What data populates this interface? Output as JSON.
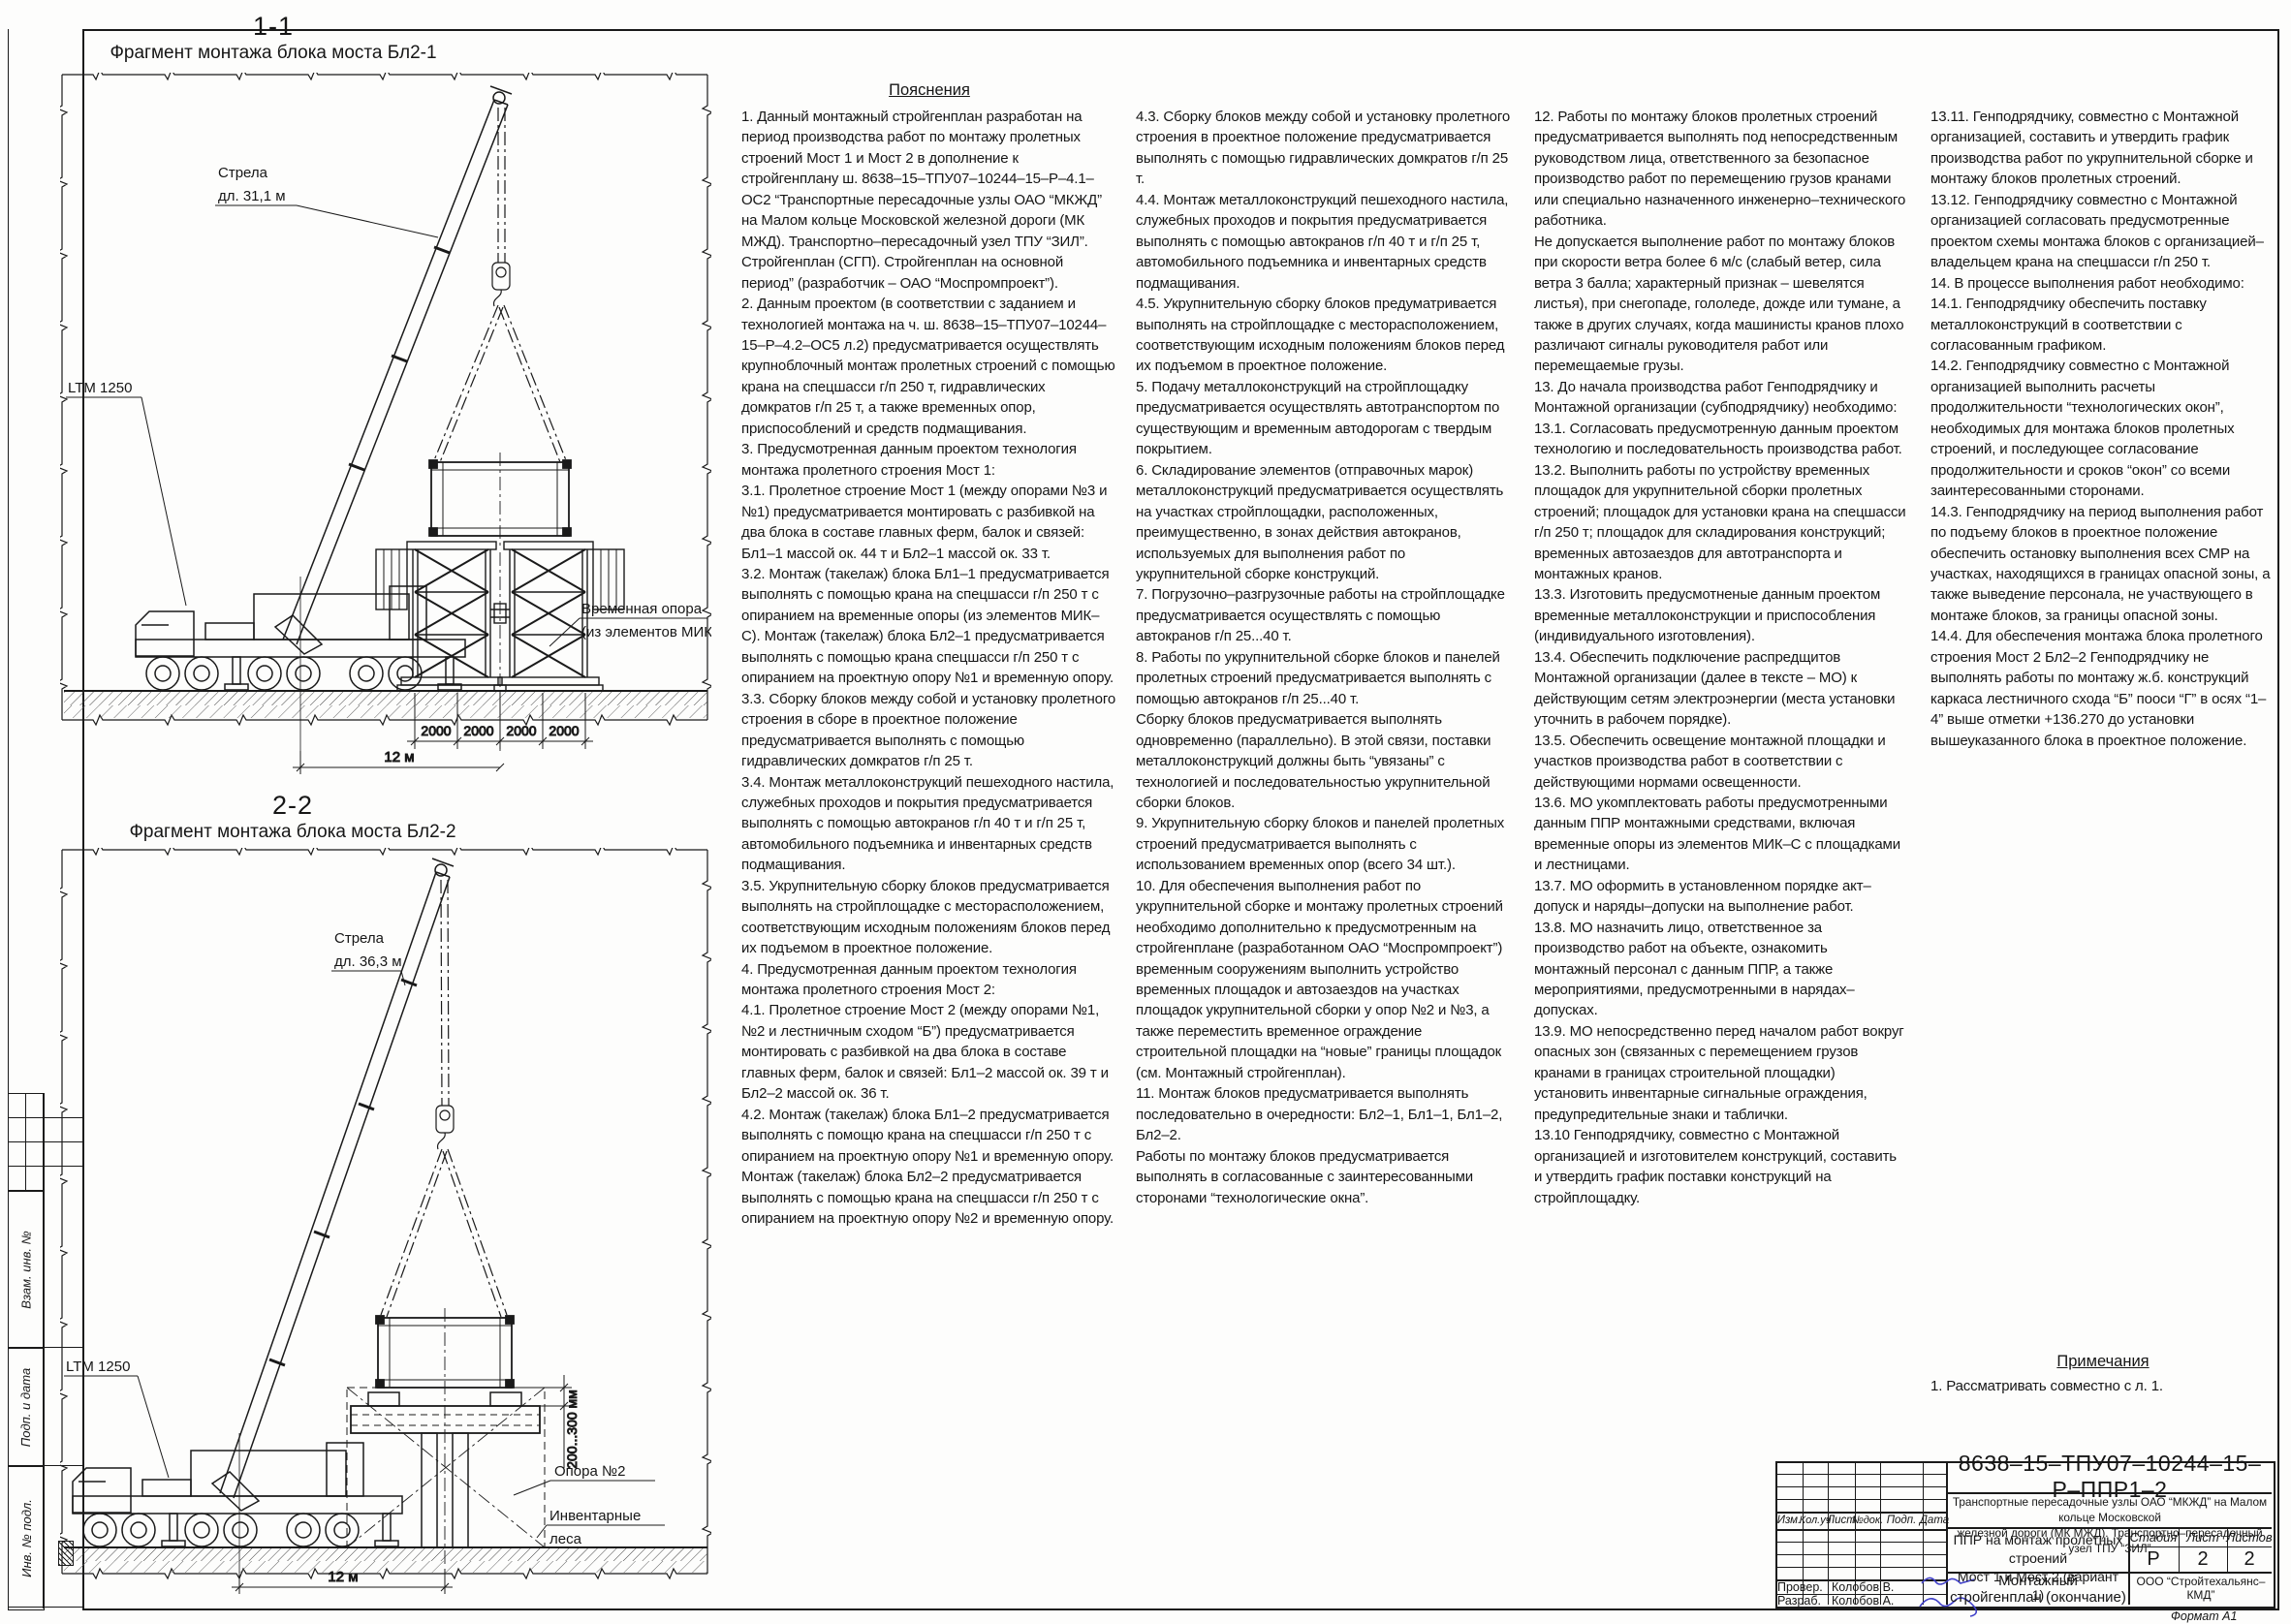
{
  "views": {
    "view1": {
      "section": "1-1",
      "caption": "Фрагмент монтажа блока моста Бл2-1",
      "crane_model": "LTM 1250",
      "boom_label_1": "Стрела",
      "boom_label_2": "дл. 31,1 м",
      "support_label_1": "Временная опора",
      "support_label_2": "(из элементов МИК-С)",
      "dim_segments": [
        "2000",
        "2000",
        "2000",
        "2000"
      ],
      "radius_dim": "12 м"
    },
    "view2": {
      "section": "2-2",
      "caption": "Фрагмент монтажа блока моста Бл2-2",
      "crane_model": "LTM 1250",
      "boom_label_1": "Стрела",
      "boom_label_2": "дл. 36,3 м",
      "pier_label": "Опора №2",
      "scaffold_label_1": "Инвентарные",
      "scaffold_label_2": "леса",
      "gap_dim": "200...300 мм",
      "radius_dim": "12 м"
    },
    "note_label": ""
  },
  "notes": {
    "title": "Пояснения",
    "col1": [
      "1. Данный монтажный стройгенплан разработан на период производства работ по монтажу пролетных строений Мост 1 и Мост 2 в дополнение к стройгенплану ш. 8638–15–ТПУ07–10244–15–Р–4.1–ОС2 “Транспортные пересадочные узлы ОАО “МКЖД” на Малом кольце Московской железной дороги (МК МЖД). Транспортно–пересадочный узел ТПУ “ЗИЛ”. Стройгенплан (СГП). Стройгенплан на основной период” (разработчик – ОАО “Моспромпроект”).",
      "2. Данным проектом (в соответствии с заданием и технологией монтажа на ч. ш. 8638–15–ТПУ07–10244–15–Р–4.2–ОС5 л.2) предусматривается осуществлять крупноблочный монтаж пролетных строений с помощью крана на спецшасси г/п 250 т, гидравлических домкратов г/п 25 т, а также временных опор, приспособлений и средств подмащивания.",
      "3. Предусмотренная данным проектом технология монтажа пролетного строения Мост 1:",
      "3.1. Пролетное строение Мост 1 (между опорами №3 и №1) предусматривается монтировать с разбивкой на два блока в составе главных ферм, балок и связей: Бл1–1 массой ок. 44 т и Бл2–1 массой ок. 33 т.",
      "3.2. Монтаж (такелаж) блока Бл1–1 предусматривается выполнять с помощью крана на спецшасси г/п 250 т с опиранием на временные опоры (из элементов МИК–С). Монтаж (такелаж) блока Бл2–1 предусматривается выполнять с помощью крана спецшасси г/п 250 т с опиранием на проектную опору №1 и временную опору.",
      "3.3. Сборку блоков между собой и установку пролетного строения в сборе в проектное положение предусматривается выполнять с помощью гидравлических домкратов г/п 25 т.",
      "3.4. Монтаж металлоконструкций пешеходного настила, служебных проходов и покрытия предусматривается выполнять с помощью автокранов г/п 40 т и г/п 25 т, автомобильного подъемника и инвентарных средств подмащивания.",
      "3.5. Укрупнительную сборку блоков предусматривается выполнять на стройплощадке с месторасположением, соответствующим исходным положениям блоков перед их подъемом в проектное положение.",
      "4. Предусмотренная данным проектом технология монтажа пролетного строения Мост 2:",
      "4.1. Пролетное строение Мост 2 (между опорами №1, №2 и лестничным сходом “Б”) предусматривается монтировать с разбивкой на два блока в составе главных ферм, балок и связей: Бл1–2 массой ок. 39 т и Бл2–2 массой ок. 36 т.",
      "4.2. Монтаж (такелаж) блока Бл1–2 предусматривается выполнять с помощю крана на спецшасси г/п 250 т с опиранием на проектную опору №1 и временную опору. Монтаж (такелаж) блока Бл2–2 предусматривается выполнять с помощью крана на спецшасси г/п 250 т с опиранием на проектную опору №2 и временную опору."
    ],
    "col2": [
      "4.3. Сборку блоков между собой и установку пролетного строения в проектное положение предусматривается выполнять с помощью гидравлических домкратов г/п 25 т.",
      "4.4. Монтаж металлоконструкций пешеходного настила, служебных проходов и покрытия предусматривается выполнять с помощью автокранов г/п 40 т и г/п 25 т, автомобильного подъемника и инвентарных средств подмащивания.",
      "4.5. Укрупнительную сборку блоков предуматривается выполнять на стройплощадке с месторасположением, соответствующим исходным положениям блоков перед их подъемом в проектное положение.",
      "5. Подачу металлоконструкций на стройплощадку предусматривается осуществлять автотранспортом по существующим и временным автодорогам с твердым покрытием.",
      "6. Складирование элементов (отправочных марок) металлоконструкций предусматривается осуществлять на участках стройплощадки, расположенных, преимущественно, в зонах действия автокранов, используемых для выполнения работ по укрупнительной сборке конструкций.",
      "7. Погрузочно–разгрузочные работы на стройплощадке предусматривается осуществлять с помощью автокранов г/п 25...40 т.",
      "8. Работы по укрупнительной сборке блоков и панелей пролетных строений предусматривается выполнять с помощью автокранов г/п 25...40 т.",
      "Сборку блоков предусматривается выполнять одновременно (параллельно). В этой связи, поставки металлоконструкций должны быть “увязаны” с технологией и последовательностью укрупнительной сборки блоков.",
      "9. Укрупнительную сборку блоков и панелей пролетных строений предусматривается выполнять с использованием временных опор (всего 34 шт.).",
      "10. Для обеспечения выполнения работ по укрупнительной сборке и монтажу пролетных строений необходимо дополнительно к предусмотренным на стройгенплане (разработанном ОАО “Моспромпроект”) временным сооружениям выполнить устройство временных площадок и автозаездов на участках площадок укрупнительной сборки у опор №2 и №3, а также переместить временное ограждение строительной площадки на “новые” границы площадок (см. Монтажный стройгенплан).",
      "11. Монтаж блоков предусматривается выполнять последовательно в очередности: Бл2–1, Бл1–1, Бл1–2, Бл2–2.",
      "Работы по монтажу блоков предусматривается выполнять в согласованные с заинтересованными сторонами “технологические окна”."
    ],
    "col3": [
      "12. Работы по монтажу блоков пролетных строений предусматривается выполнять под непосредственным руководством лица, ответственного за безопасное производство работ по перемещению грузов кранами или специально назначенного инженерно–технического работника.",
      "Не допускается выполнение работ по монтажу блоков при скорости ветра более 6 м/с (слабый ветер, сила ветра 3 балла; характерный признак – шевелятся листья), при снегопаде, гололеде, дожде или тумане, а также в других случаях, когда машинисты кранов плохо различают сигналы руководителя работ или перемещаемые грузы.",
      "13. До начала производства работ Генподрядчику и Монтажной организации (субподрядчику) необходимо:",
      "13.1. Согласовать предусмотренную данным проектом технологию и последовательность производства работ.",
      "13.2. Выполнить работы по устройству временных площадок для укрупнительной сборки пролетных строений; площадок для установки крана на спецшасси г/п 250 т; площадок для складирования конструкций; временных автозаездов для автотранспорта и монтажных кранов.",
      "13.3. Изготовить предусмотненые данным проектом временные металлоконструкции и приспособления (индивидуального изготовления).",
      "13.4. Обеспечить подключение распредщитов Монтажной организации (далее в тексте – МО) к действующим сетям электроэнергии (места установки уточнить в рабочем порядке).",
      "13.5. Обеспечить освещение монтажной площадки и участков производства работ в соответствии с действующими нормами освещенности.",
      "13.6. МО укомплектовать работы предусмотренными данным ППР монтажными средствами, включая временные опоры из элементов МИК–С с площадками и лестницами.",
      "13.7. МО оформить в установленном порядке акт–допуск и наряды–допуски на выполнение работ.",
      "13.8. МО назначить лицо, ответственное за производство работ на объекте, ознакомить монтажный персонал с данным ППР, а также мероприятиями, предусмотренными в нарядах–допусках.",
      "13.9. МО непосредственно перед началом работ вокруг опасных зон (связанных с перемещением грузов кранами в границах строительной площадки) установить инвентарные сигнальные ограждения, предупредительные знаки и таблички.",
      "13.10 Генподрядчику, совместно с Монтажной организацией и изготовителем конструкций, составить и утвердить график поставки конструкций на стройплощадку."
    ],
    "col4": [
      "13.11. Генподрядчику, совместно с Монтажной организацией, составить и утвердить график производства работ по укрупнительной сборке и монтажу блоков пролетных строений.",
      "13.12. Генподрядчику совместно с Монтажной организацией согласовать предусмотренные проектом схемы монтажа блоков с организацией–владельцем крана на спецшасси г/п 250 т.",
      "14. В процессе выполнения работ необходимо:",
      "14.1. Генподрядчику обеспечить поставку металлоконструкций в соответствии с согласованным графиком.",
      "14.2. Генподрядчику совместно с Монтажной организацией выполнить расчеты продолжительности “технологических окон”, необходимых для монтажа блоков пролетных строений, и последующее согласование продолжительности и сроков “окон” со всеми заинтересованными сторонами.",
      "14.3. Генподрядчику на период выполнения работ по подъему блоков в проектное положение обеспечить остановку выполнения всех СМР на участках, находящихся в границах опасной зоны, а также выведение персонала, не участвующего в монтаже блоков, за границы опасной зоны.",
      "14.4. Для обеспечения монтажа блока пролетного строения Мост 2 Бл2–2 Генподрядчику не выполнять работы по монтажу ж.б. конструкций каркаса лестничного схода “Б” пооси “Г” в осях “1–4” выше отметки +136.270 до установки вышеуказанного блока в проектное положение."
    ],
    "remarks_title": "Примечания",
    "remarks": [
      "1. Рассматривать совместно с л. 1."
    ]
  },
  "title_block": {
    "doc_number": "8638–15–ТПУ07–10244–15–Р–ППР1–2",
    "project_line1": "Транспортные пересадочные узлы ОАО “МКЖД” на Малом кольце Московской",
    "project_line2": "железной дороги (МК МЖД). Транспортно–пересадочный узел ТПУ “ЗИЛ”",
    "object_line1": "ППР на монтаж пролетных строений",
    "object_line2": "Мост 1 и Мост 2 (вариант 1)",
    "sheet_title_1": "Монтажный",
    "sheet_title_2": "стройгенплан (окончание)",
    "company": "ООО “Стройтехальянс–КМД”",
    "stage_label": "Стадия",
    "sheet_label": "Лист",
    "sheets_label": "Листов",
    "stage": "Р",
    "sheet": "2",
    "sheets": "2",
    "cols": [
      "Изм.",
      "Кол.уч",
      "Лист",
      "№док.",
      "Подп.",
      "Дата"
    ],
    "rows": [
      {
        "role": "Провер.",
        "name": "Колобов В."
      },
      {
        "role": "Разраб.",
        "name": "Колобов А."
      }
    ],
    "format": "Формат А1"
  },
  "side_stamp": {
    "cells": [
      "Взам. инв. №",
      "Подп. и дата",
      "Инв. № подл."
    ]
  },
  "colors": {
    "ink": "#1a1a1a",
    "signature": "#4040c8"
  }
}
